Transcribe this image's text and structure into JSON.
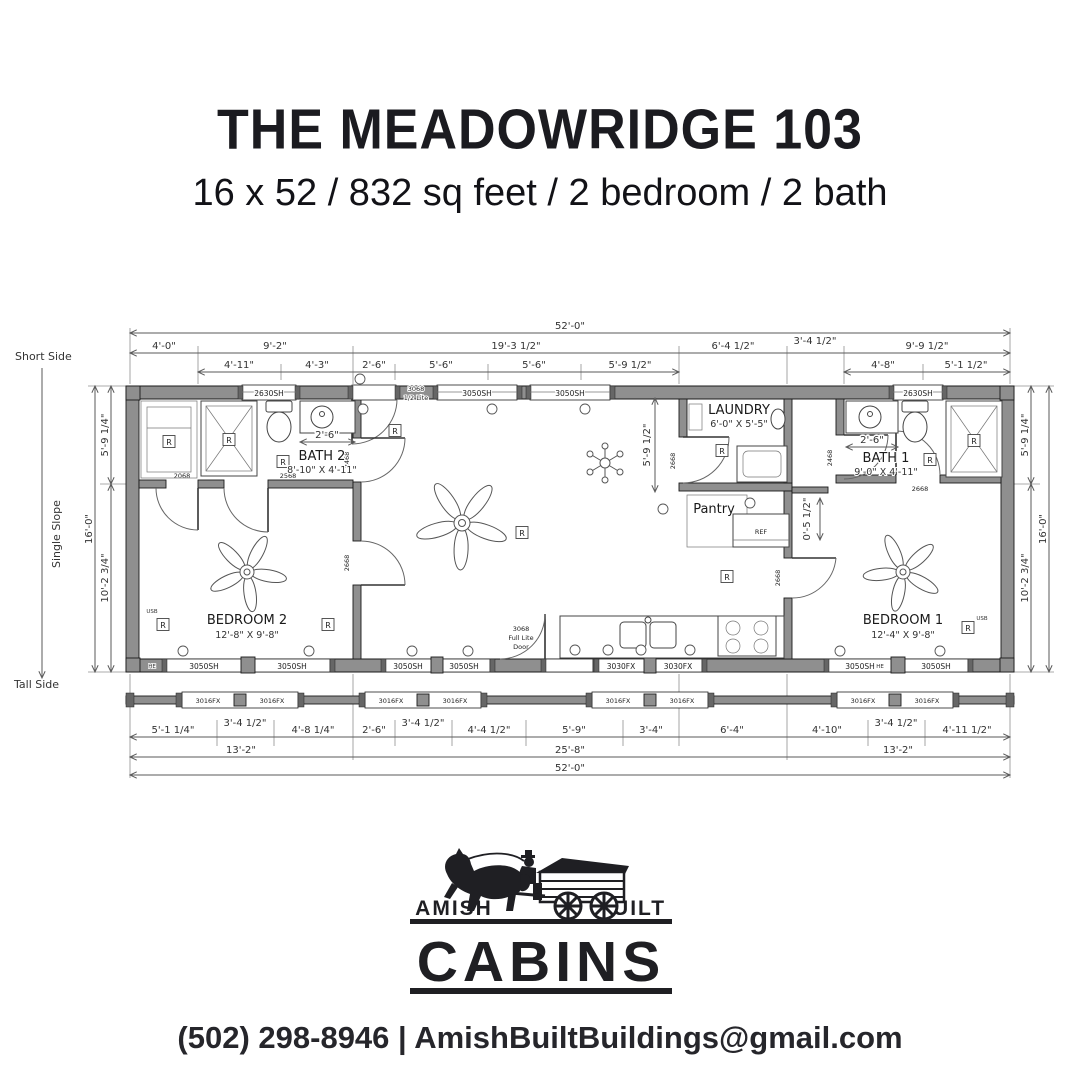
{
  "header": {
    "title": "THE MEADOWRIDGE 103",
    "subtitle": "16 x 52 / 832 sq feet / 2 bedroom / 2 bath"
  },
  "plan": {
    "side_labels": {
      "short": "Short Side",
      "slope": "Single Slope",
      "tall": "Tall Side"
    },
    "dims": {
      "overall": "52'-0\"",
      "top2": [
        "4'-0\"",
        "9'-2\"",
        "19'-3 1/2\"",
        "6'-4 1/2\"",
        "3'-4 1/2\"",
        "9'-9 1/2\""
      ],
      "top3": [
        "4'-11\"",
        "4'-3\"",
        "2'-6\"",
        "5'-6\"",
        "5'-6\"",
        "5'-9 1/2\"",
        "4'-8\"",
        "5'-1 1/2\""
      ],
      "bottom1": [
        "5'-1 1/4\"",
        "3'-4 1/2\"",
        "4'-8 1/4\"",
        "2'-6\"",
        "3'-4 1/2\"",
        "4'-4 1/2\"",
        "5'-9\"",
        "3'-4\"",
        "6'-4\"",
        "4'-10\"",
        "3'-4 1/2\"",
        "4'-11 1/2\""
      ],
      "bottom2": [
        "13'-2\"",
        "25'-8\"",
        "13'-2\""
      ],
      "left_total": "16'-0\"",
      "left_upper": "5'-9 1/4\"",
      "left_lower": "10'-2 3/4\"",
      "right_total": "16'-0\"",
      "right_upper": "5'-9 1/4\"",
      "right_lower": "10'-2 3/4\"",
      "laundry_wall": "5'-9 1/2\"",
      "stub": "0'-5 1/2\"",
      "bath2_vanity": "2'-6\"",
      "bath1_vanity": "2'-6\""
    },
    "rooms": {
      "bath2": {
        "name": "BATH 2",
        "size": "8'-10\" X 4'-11\""
      },
      "bedroom2": {
        "name": "BEDROOM 2",
        "size": "12'-8\" X 9'-8\""
      },
      "laundry": {
        "name": "LAUNDRY",
        "size": "6'-0\" X 5'-5\""
      },
      "pantry": {
        "name": "Pantry"
      },
      "bath1": {
        "name": "BATH 1",
        "size": "9'-0\" X 4'-11\""
      },
      "bedroom1": {
        "name": "BEDROOM 1",
        "size": "12'-4\" X 9'-8\""
      },
      "ref": "REF"
    },
    "codes": {
      "w2630": "2630SH",
      "w3050": "3050SH",
      "w3030": "3030FX",
      "w3016": "3016FX",
      "d2068": "2068",
      "d2568": "2568",
      "d2468": "2468",
      "d2668": "2668",
      "d3068a_l1": "3068",
      "d3068a_l2": "1/2 Lite",
      "d3068b_l1": "3068",
      "d3068b_l2": "Full Lite",
      "d3068b_l3": "Door"
    },
    "electrical": {
      "receptacle": "R",
      "usb": "USB",
      "he": "HE"
    }
  },
  "logo": {
    "amish": "AMISH",
    "built": "BUILT",
    "cabins": "CABINS"
  },
  "contact": {
    "phone": "(502) 298-8946",
    "separator": "|",
    "email": "AmishBuiltBuildings@gmail.com"
  },
  "colors": {
    "wall": "#8f8f8f",
    "ink": "#1f1f23",
    "dim": "#5a5a5a"
  }
}
